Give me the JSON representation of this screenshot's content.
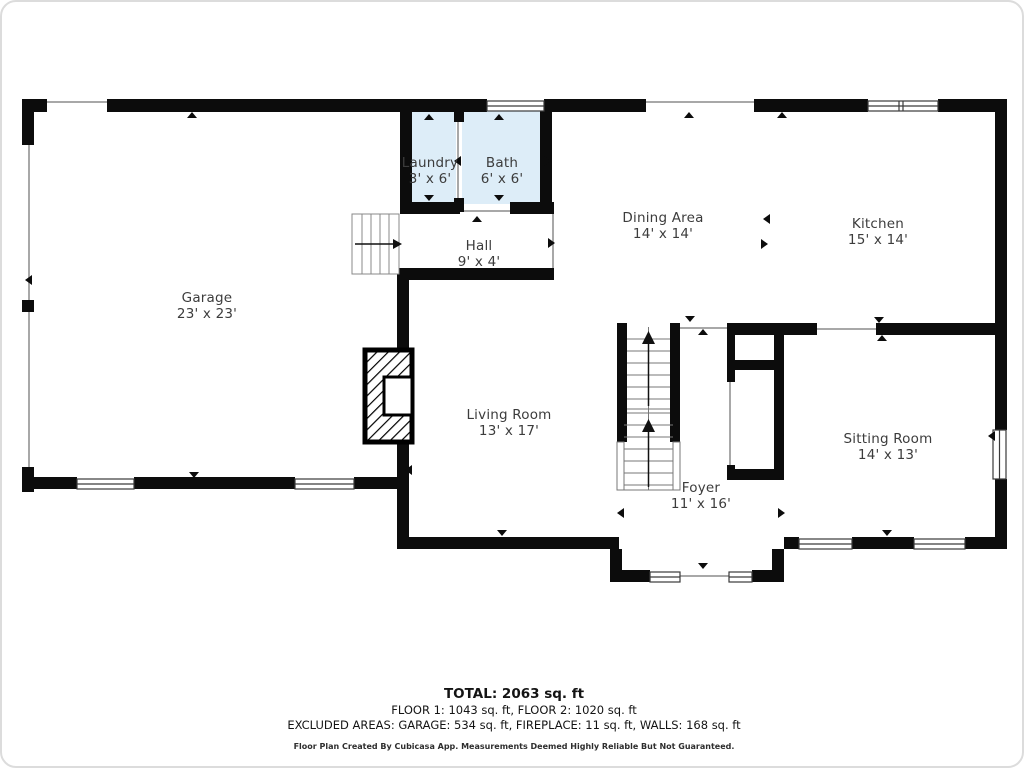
{
  "title": "Floor plan - Floor 1",
  "palette": {
    "wall": "#0c0c0c",
    "room_fill_wet_areas": "#ddedf8",
    "label_text": "#3c3c3c",
    "footer_text": "#141414",
    "opening_line": "#a8a8a8",
    "background": "#ffffff"
  },
  "rooms": [
    {
      "id": "laundry",
      "name": "Laundry",
      "dims": "3' x 6'"
    },
    {
      "id": "bath",
      "name": "Bath",
      "dims": "6' x 6'"
    },
    {
      "id": "dining",
      "name": "Dining Area",
      "dims": "14' x 14'"
    },
    {
      "id": "kitchen",
      "name": "Kitchen",
      "dims": "15' x 14'"
    },
    {
      "id": "hall",
      "name": "Hall",
      "dims": "9' x 4'"
    },
    {
      "id": "garage",
      "name": "Garage",
      "dims": "23' x 23'"
    },
    {
      "id": "living",
      "name": "Living Room",
      "dims": "13' x 17'"
    },
    {
      "id": "foyer",
      "name": "Foyer",
      "dims": "11' x 16'"
    },
    {
      "id": "sitting",
      "name": "Sitting Room",
      "dims": "14' x 13'"
    }
  ],
  "footer": {
    "total": "TOTAL: 2063 sq. ft",
    "floors": "FLOOR 1: 1043 sq. ft, FLOOR 2: 1020 sq. ft",
    "excluded": "EXCLUDED AREAS: GARAGE: 534 sq. ft, FIREPLACE: 11 sq. ft, WALLS: 168 sq. ft",
    "credit": "Floor Plan Created By Cubicasa App. Measurements Deemed Highly Reliable But Not Guaranteed."
  }
}
